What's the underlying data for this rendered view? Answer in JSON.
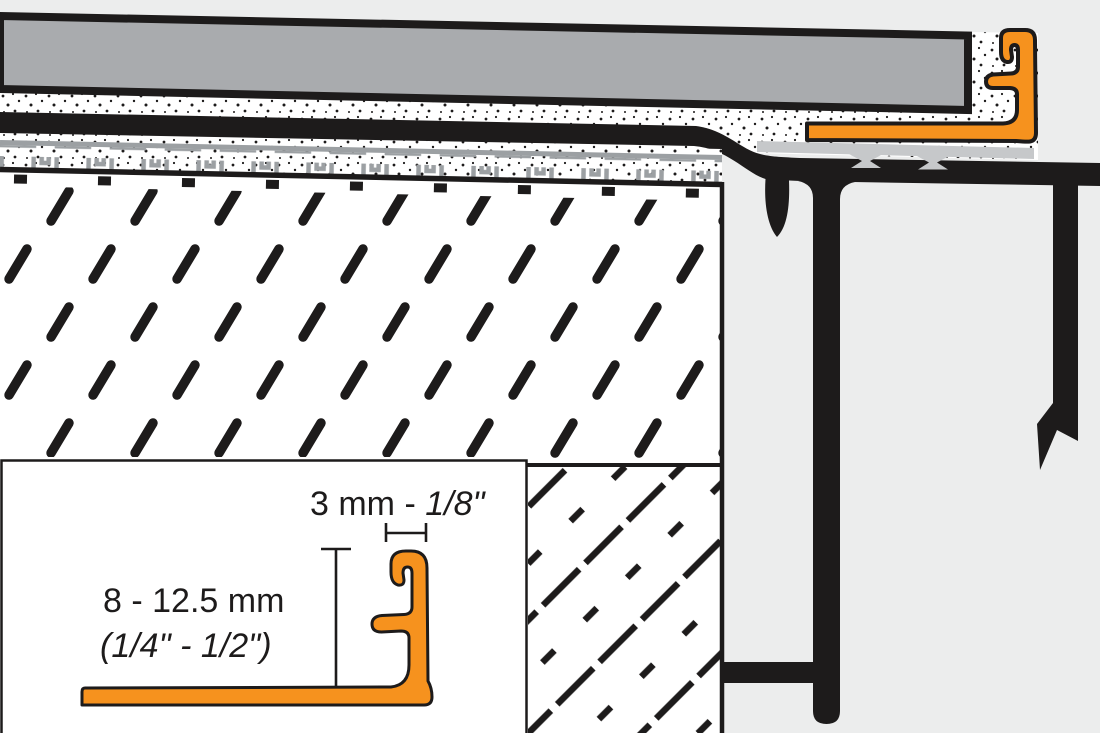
{
  "inset": {
    "dim_top_metric": "3 mm - ",
    "dim_top_imperial": "1/8\"",
    "dim_height_metric": "8 - 12.5 mm",
    "dim_height_imperial": "(1/4\" - 1/2\")"
  },
  "colors": {
    "profile_orange": "#F6921E",
    "tile_gray": "#A9ABAE",
    "support_gray": "#C6C8CA",
    "membrane_gray": "#9CA0A3",
    "line_black": "#1D1B1B",
    "background": "#ECEDED",
    "paper_white": "#FFFFFF"
  }
}
